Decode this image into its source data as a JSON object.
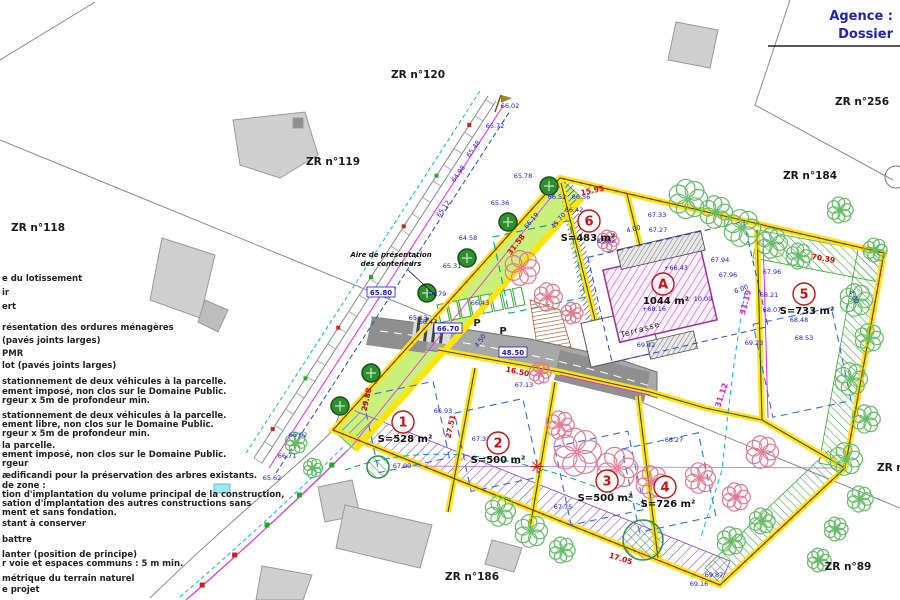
{
  "title_block": {
    "agence": "Agence :",
    "dossier": "Dossier"
  },
  "cadastral_labels": [
    {
      "t": "ZR n°120",
      "x": 418,
      "y": 78
    },
    {
      "t": "ZR n°119",
      "x": 333,
      "y": 165
    },
    {
      "t": "ZR n°118",
      "x": 38,
      "y": 231
    },
    {
      "t": "ZR n°256",
      "x": 862,
      "y": 105
    },
    {
      "t": "ZR n°184",
      "x": 810,
      "y": 179
    },
    {
      "t": "ZR n°186",
      "x": 472,
      "y": 580
    },
    {
      "t": "ZR n°89",
      "x": 848,
      "y": 570
    },
    {
      "t": "ZR n°",
      "x": 893,
      "y": 471
    }
  ],
  "parcels": [
    {
      "num": "1",
      "area": "S=528 m²",
      "cx": 403,
      "cy": 422,
      "ax": 405,
      "ay": 442
    },
    {
      "num": "2",
      "area": "S=500 m²",
      "cx": 498,
      "cy": 443,
      "ax": 498,
      "ay": 463
    },
    {
      "num": "3",
      "area": "S=500 m²",
      "cx": 607,
      "cy": 481,
      "ax": 605,
      "ay": 501
    },
    {
      "num": "4",
      "area": "S=726 m²",
      "cx": 665,
      "cy": 487,
      "ax": 668,
      "ay": 507
    },
    {
      "num": "5",
      "area": "S=733 m²",
      "cx": 804,
      "cy": 294,
      "ax": 807,
      "ay": 314
    },
    {
      "num": "6",
      "area": "S=483 m²",
      "cx": 589,
      "cy": 221,
      "ax": 588,
      "ay": 241
    }
  ],
  "building_a": {
    "label": "A",
    "cx": 663,
    "cy": 284,
    "area": "1044 m²",
    "area_x": 666,
    "area_y": 304,
    "terrasse": "Terrasse",
    "terr_x": 641,
    "terr_y": 332,
    "terr_rot": -16
  },
  "annotations": [
    {
      "t": "Aire de présentation",
      "x": 391,
      "y": 257,
      "c": "ann"
    },
    {
      "t": "des conteneurs",
      "x": 391,
      "y": 266,
      "c": "ann"
    },
    {
      "t": "P",
      "x": 477,
      "y": 326,
      "c": "pp"
    },
    {
      "t": "P",
      "x": 503,
      "y": 334,
      "c": "pp"
    }
  ],
  "spot_elevations": [
    {
      "t": "66.52",
      "x": 557,
      "y": 199
    },
    {
      "t": "66.56",
      "x": 581,
      "y": 199
    },
    {
      "t": "66.42",
      "x": 574,
      "y": 212
    },
    {
      "t": "45.70",
      "x": 560,
      "y": 222,
      "r": -50
    },
    {
      "t": "67.33",
      "x": 657,
      "y": 217
    },
    {
      "t": "67.27",
      "x": 658,
      "y": 232
    },
    {
      "t": "4.00",
      "x": 634,
      "y": 231,
      "r": -15
    },
    {
      "t": "66.02",
      "x": 606,
      "y": 243
    },
    {
      "t": "+66.43",
      "x": 676,
      "y": 270
    },
    {
      "t": "67.94",
      "x": 720,
      "y": 262
    },
    {
      "t": "67.96",
      "x": 728,
      "y": 277
    },
    {
      "t": "6.00",
      "x": 742,
      "y": 291,
      "r": -20
    },
    {
      "t": "+68.16",
      "x": 654,
      "y": 311
    },
    {
      "t": "10.00",
      "x": 703,
      "y": 301
    },
    {
      "t": "69.42",
      "x": 646,
      "y": 347
    },
    {
      "t": "67.96",
      "x": 772,
      "y": 274
    },
    {
      "t": "68.21",
      "x": 769,
      "y": 297
    },
    {
      "t": "68.07",
      "x": 772,
      "y": 312
    },
    {
      "t": "68.48",
      "x": 799,
      "y": 322
    },
    {
      "t": "68.53",
      "x": 804,
      "y": 340
    },
    {
      "t": "69.23",
      "x": 754,
      "y": 345
    },
    {
      "t": "4.00",
      "x": 852,
      "y": 298,
      "r": 60
    },
    {
      "t": "66.93",
      "x": 443,
      "y": 413
    },
    {
      "t": "67.32",
      "x": 481,
      "y": 441
    },
    {
      "t": "67.09",
      "x": 402,
      "y": 468
    },
    {
      "t": "68.27",
      "x": 674,
      "y": 442
    },
    {
      "t": "67.75",
      "x": 563,
      "y": 509
    },
    {
      "t": "69.16",
      "x": 699,
      "y": 586
    },
    {
      "t": "69.87",
      "x": 714,
      "y": 577
    },
    {
      "t": "67.13",
      "x": 524,
      "y": 387
    },
    {
      "t": "66.47",
      "x": 428,
      "y": 324
    },
    {
      "t": "4.50",
      "x": 482,
      "y": 342,
      "r": -55
    },
    {
      "t": "66.19",
      "x": 533,
      "y": 222,
      "r": -50
    },
    {
      "t": "65.78",
      "x": 523,
      "y": 178
    },
    {
      "t": "65.36",
      "x": 500,
      "y": 205
    },
    {
      "t": "64.58",
      "x": 468,
      "y": 240
    },
    {
      "t": "65.31",
      "x": 452,
      "y": 268
    },
    {
      "t": "64.79",
      "x": 437,
      "y": 296
    },
    {
      "t": "65.13",
      "x": 418,
      "y": 320
    },
    {
      "t": "66.62",
      "x": 298,
      "y": 437
    },
    {
      "t": "66.71",
      "x": 287,
      "y": 458
    },
    {
      "t": "65.62",
      "x": 272,
      "y": 480
    },
    {
      "t": "65.48",
      "x": 475,
      "y": 150,
      "r": -55
    },
    {
      "t": "64.98",
      "x": 460,
      "y": 175,
      "r": -55
    },
    {
      "t": "65.72",
      "x": 495,
      "y": 128
    },
    {
      "t": "66.02",
      "x": 510,
      "y": 108
    },
    {
      "t": "65.12",
      "x": 445,
      "y": 210,
      "r": -55
    },
    {
      "t": "66.43",
      "x": 480,
      "y": 305
    }
  ],
  "boxed_levels": [
    {
      "t": "65.80",
      "x": 381,
      "y": 295
    },
    {
      "t": "66.70",
      "x": 448,
      "y": 331
    },
    {
      "t": "48.50",
      "x": 513,
      "y": 355
    }
  ],
  "dimensions_red": [
    {
      "t": "15.95",
      "x": 593,
      "y": 193,
      "r": -12
    },
    {
      "t": "31.58",
      "x": 518,
      "y": 246,
      "r": -52
    },
    {
      "t": "27.51",
      "x": 453,
      "y": 427,
      "r": -78
    },
    {
      "t": "29.88",
      "x": 369,
      "y": 400,
      "r": -78
    },
    {
      "t": "70.39",
      "x": 823,
      "y": 261,
      "r": 10
    },
    {
      "t": "17.05",
      "x": 620,
      "y": 561,
      "r": 17
    },
    {
      "t": "16.50",
      "x": 517,
      "y": 374,
      "r": 12
    }
  ],
  "dimensions_magenta": [
    {
      "t": "31.19",
      "x": 748,
      "y": 303,
      "r": -75
    },
    {
      "t": "31.12",
      "x": 724,
      "y": 396,
      "r": -72
    }
  ],
  "legend_lines": [
    {
      "t": "e du lotissement",
      "y": 281
    },
    {
      "t": "ir",
      "y": 295
    },
    {
      "t": "ert",
      "y": 309
    },
    {
      "t": "résentation des ordures ménagères",
      "y": 330
    },
    {
      "t": "(pavés joints larges)",
      "y": 343
    },
    {
      "t": "PMR",
      "y": 356
    },
    {
      "t": "lot (pavés joints larges)",
      "y": 368
    },
    {
      "t": "stationnement de deux véhicules à la parcelle.",
      "y": 384
    },
    {
      "t": "ement imposé, non clos sur le Domaine Public.",
      "y": 394
    },
    {
      "t": "rgeur x 5m de profondeur min.",
      "y": 403
    },
    {
      "t": "stationnement de deux véhicules à la parcelle.",
      "y": 418
    },
    {
      "t": "ement libre, non clos sur le Domaine Public.",
      "y": 427
    },
    {
      "t": "rgeur x 5m de profondeur min.",
      "y": 436
    },
    {
      "t": "la parcelle.",
      "y": 448
    },
    {
      "t": "ement imposé, non clos sur le Domaine Public.",
      "y": 457
    },
    {
      "t": "rgeur",
      "y": 466
    },
    {
      "t": "ædificandi pour la préservation des arbres existants.",
      "y": 478
    },
    {
      "t": "de zone :",
      "y": 488
    },
    {
      "t": "tion d'implantation du volume principal de la construction,",
      "y": 497
    },
    {
      "t": "sation d'implantation des autres constructions sans",
      "y": 506
    },
    {
      "t": "ment et sans fondation.",
      "y": 515
    },
    {
      "t": "stant à conserver",
      "y": 526
    },
    {
      "t": "battre",
      "y": 542
    },
    {
      "t": "lanter (position de principe)",
      "y": 557
    },
    {
      "t": "r voie et espaces communs : 5 m min.",
      "y": 566
    },
    {
      "t": "métrique du terrain naturel",
      "y": 581
    },
    {
      "t": "e projet",
      "y": 592
    }
  ],
  "icons": {
    "star": "✳"
  },
  "trees": {
    "pink": [
      [
        522,
        268,
        16
      ],
      [
        548,
        297,
        13
      ],
      [
        572,
        313,
        10
      ],
      [
        577,
        452,
        22
      ],
      [
        617,
        468,
        19
      ],
      [
        652,
        482,
        15
      ],
      [
        560,
        425,
        13
      ],
      [
        700,
        478,
        14
      ],
      [
        736,
        497,
        13
      ],
      [
        608,
        241,
        10
      ],
      [
        762,
        452,
        15
      ],
      [
        540,
        373,
        10
      ]
    ],
    "green": [
      [
        688,
        199,
        18
      ],
      [
        716,
        212,
        15
      ],
      [
        742,
        228,
        17
      ],
      [
        772,
        243,
        14
      ],
      [
        799,
        256,
        12
      ],
      [
        856,
        300,
        15
      ],
      [
        869,
        338,
        13
      ],
      [
        851,
        379,
        15
      ],
      [
        866,
        419,
        13
      ],
      [
        846,
        459,
        15
      ],
      [
        860,
        499,
        12
      ],
      [
        836,
        529,
        11
      ],
      [
        500,
        511,
        14
      ],
      [
        531,
        531,
        15
      ],
      [
        562,
        550,
        12
      ],
      [
        296,
        443,
        10
      ],
      [
        313,
        468,
        9
      ],
      [
        731,
        541,
        13
      ],
      [
        762,
        521,
        12
      ],
      [
        819,
        560,
        11
      ],
      [
        840,
        210,
        12
      ],
      [
        875,
        250,
        11
      ]
    ],
    "planted": [
      [
        549,
        186
      ],
      [
        508,
        222
      ],
      [
        467,
        258
      ],
      [
        427,
        293
      ],
      [
        371,
        373
      ],
      [
        340,
        406
      ]
    ],
    "conserved": [
      [
        643,
        540,
        20
      ],
      [
        378,
        467,
        11
      ]
    ]
  },
  "colors": {
    "boundary_yellow": "#ffe40a",
    "road_gray": "#a8a8a8",
    "building_gray": "#cfcfcf",
    "hatch_purple": "#8844bb",
    "hatch_green": "#3aa63a",
    "spot_blue": "#1a1acc",
    "dim_red": "#e00000",
    "magenta": "#e020d0",
    "title_blue": "#2222bb"
  }
}
